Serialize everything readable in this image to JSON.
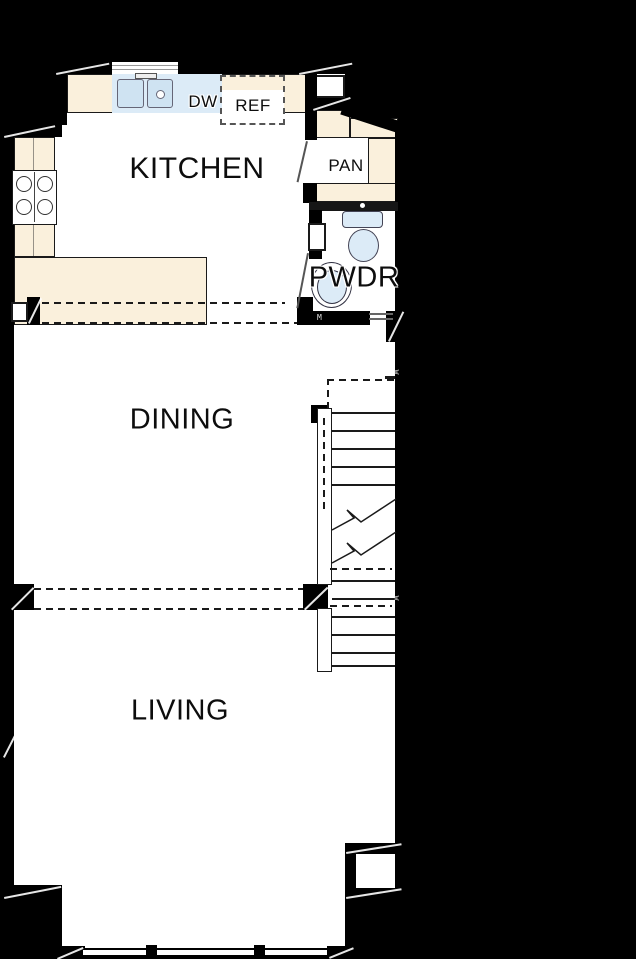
{
  "plan": {
    "rooms": {
      "kitchen": "KITCHEN",
      "dining": "DINING",
      "living": "LIVING",
      "powder": "PWDR",
      "pantry": "PAN"
    },
    "appliances": {
      "dishwasher": "DW",
      "refrigerator": "REF"
    },
    "markers": {
      "stair_wall_tag_upper": "w",
      "stair_wall_tag_lower": "w",
      "powder_door_tag": "M"
    },
    "colors": {
      "background": "#000000",
      "wall": "#000000",
      "floor": "#ffffff",
      "cabinetry": "#faf0dc",
      "fixture_blue": "#dcebf7",
      "fixture_blue_deep": "#cfe3f2",
      "line": "#1a1a1a",
      "label": "#0d0d0d"
    }
  }
}
